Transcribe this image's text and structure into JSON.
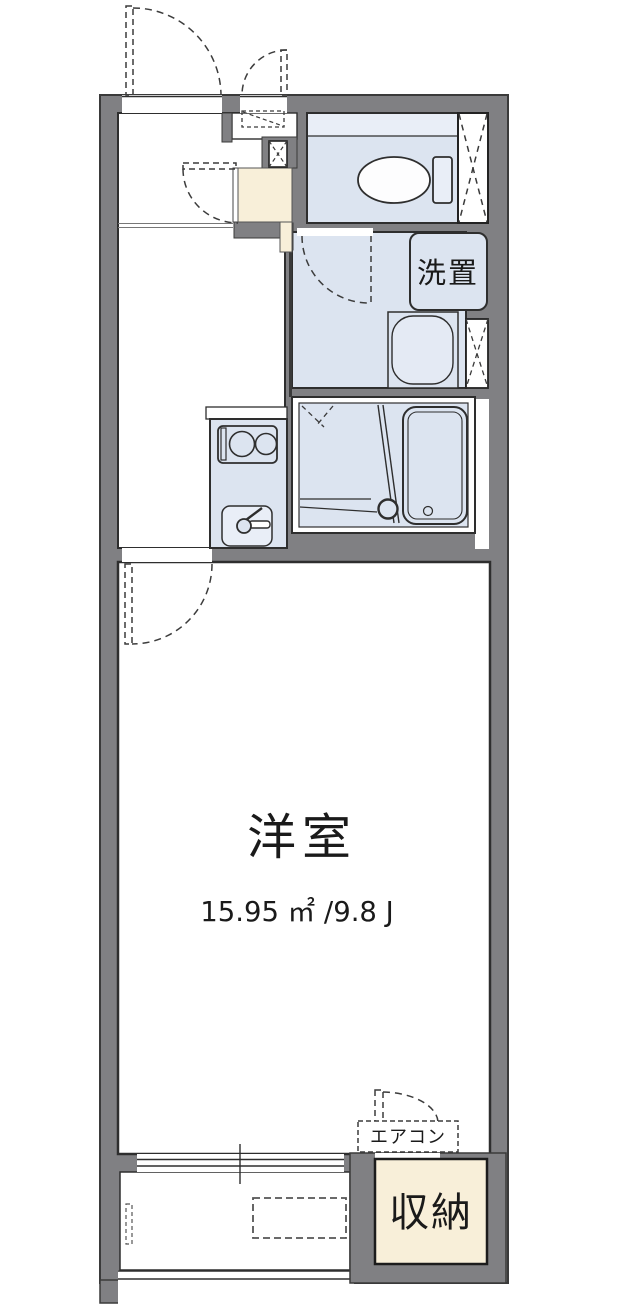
{
  "plan": {
    "rooms": {
      "main_room": {
        "label": "洋室",
        "area": "15.95 ㎡ /9.8 J"
      },
      "storage": {
        "label": "収納"
      },
      "laundry_space": {
        "label": "洗置"
      },
      "air_conditioner": {
        "label": "エアコン"
      }
    },
    "colors": {
      "wall_gray": "#808083",
      "wet_area_blue": "#dce4f0",
      "wet_area_light": "#e9eef7",
      "genkan_beige": "#f8efd9",
      "outline_dark": "#2e2e2e"
    },
    "fixtures": [
      "toilet",
      "washbasin",
      "bathtub",
      "kitchen-stove",
      "kitchen-sink",
      "sliding-window",
      "balcony-railing",
      "window-vent-marker",
      "door-swing"
    ]
  }
}
